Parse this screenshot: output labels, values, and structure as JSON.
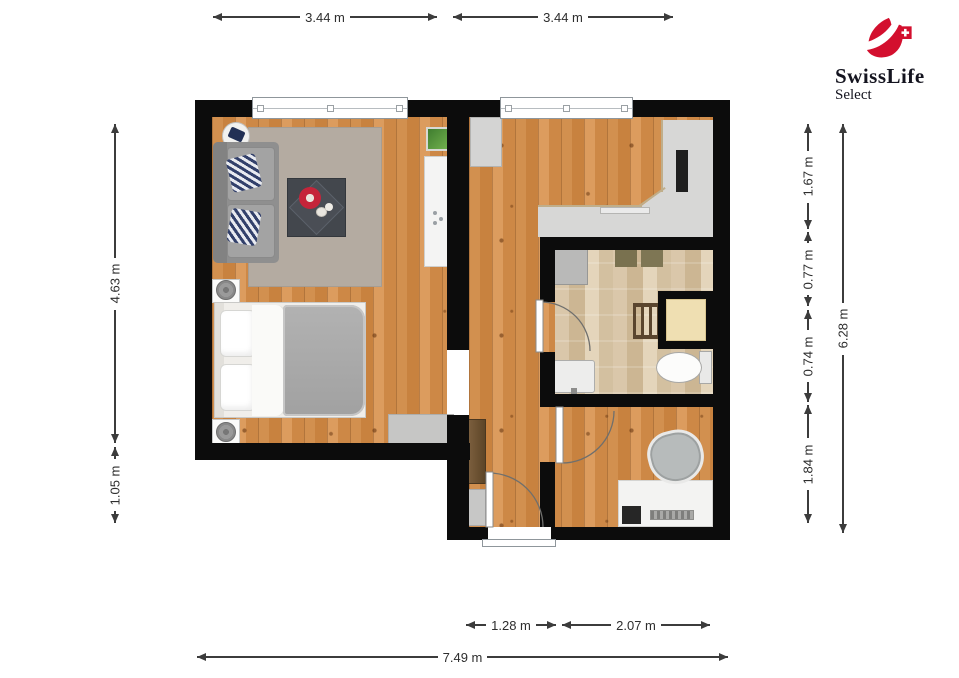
{
  "brand": {
    "name": "SwissLife",
    "sub": "Select"
  },
  "plan": {
    "dim_top_left": "3.44 m",
    "dim_top_right": "3.44 m",
    "dim_left_main": "4.63 m",
    "dim_left_lower": "1.05 m",
    "dim_right_1": "1.67 m",
    "dim_right_2": "0.77 m",
    "dim_right_3": "0.74 m",
    "dim_right_4": "1.84 m",
    "dim_right_total": "6.28 m",
    "dim_bottom_1": "1.28 m",
    "dim_bottom_2": "2.07 m",
    "dim_bottom_total": "7.49 m"
  },
  "colors": {
    "brand_red": "#d30f2e",
    "wall": "#0c0c0c",
    "wood_floor": "#cd8a4b",
    "bath_tile": "#d5c2a4",
    "counter_gray": "#d7d7d7",
    "accent_bowl_red": "#c5243a"
  }
}
